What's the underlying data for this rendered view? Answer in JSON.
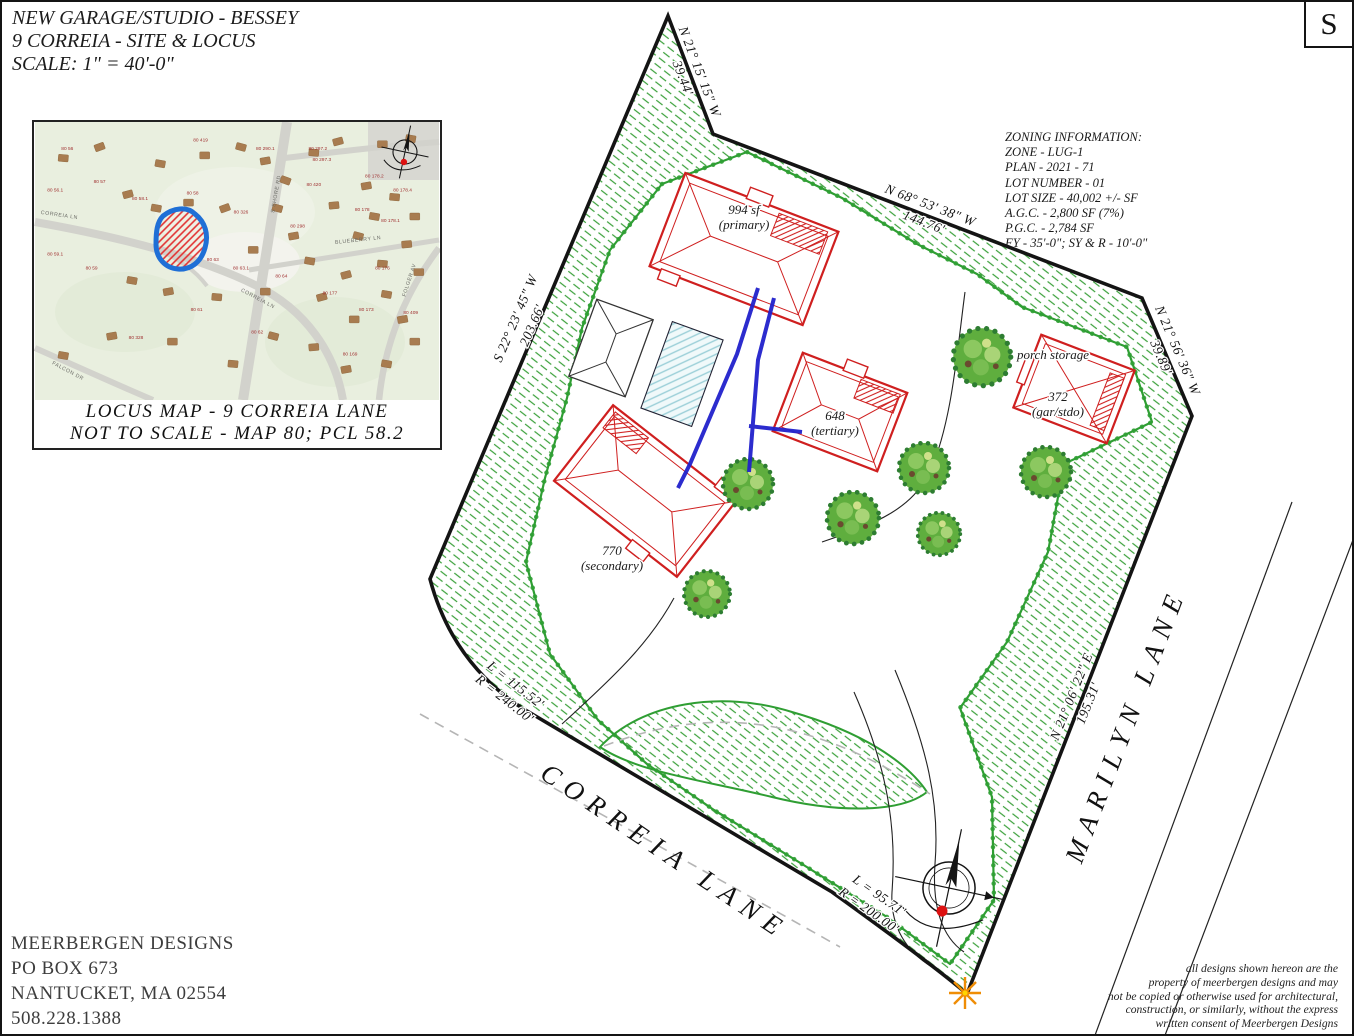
{
  "title_block": {
    "line1": "NEW GARAGE/STUDIO - BESSEY",
    "line2": "9 CORREIA - SITE & LOCUS",
    "line3": "SCALE:  1\" = 40'-0\""
  },
  "sheet_label": "S",
  "locus_map": {
    "caption_line1": "LOCUS MAP  -  9  CORREIA  LANE",
    "caption_line2": "NOT TO SCALE - MAP 80; PCL 58.2",
    "road_labels": [
      {
        "text": "CORREIA LN",
        "x": 6,
        "y": 34,
        "angle": 8
      },
      {
        "text": "CORREIA LN",
        "x": 55,
        "y": 64,
        "angle": 28
      },
      {
        "text": "S SHORE RD",
        "x": 60,
        "y": 26,
        "angle": -80
      },
      {
        "text": "BLUEBERRY LN",
        "x": 80,
        "y": 43,
        "angle": -6
      },
      {
        "text": "FALCON DR",
        "x": 8,
        "y": 90,
        "angle": 28
      },
      {
        "text": "FOLGER AV",
        "x": 93,
        "y": 57,
        "angle": -72
      }
    ],
    "parcel_labels": [
      {
        "text": "80 56",
        "x": 8,
        "y": 10
      },
      {
        "text": "80 419",
        "x": 41,
        "y": 7
      },
      {
        "text": "80 290.1",
        "x": 57,
        "y": 10
      },
      {
        "text": "80 297.2",
        "x": 70,
        "y": 10
      },
      {
        "text": "80 297.3",
        "x": 71,
        "y": 14
      },
      {
        "text": "80 57",
        "x": 16,
        "y": 22
      },
      {
        "text": "80 56.1",
        "x": 5,
        "y": 25
      },
      {
        "text": "80 58.1",
        "x": 26,
        "y": 28
      },
      {
        "text": "80 58",
        "x": 39,
        "y": 26
      },
      {
        "text": "80 420",
        "x": 69,
        "y": 23
      },
      {
        "text": "80 178.2",
        "x": 84,
        "y": 20
      },
      {
        "text": "80 178.4",
        "x": 91,
        "y": 25
      },
      {
        "text": "80 326",
        "x": 51,
        "y": 33
      },
      {
        "text": "80 178",
        "x": 81,
        "y": 32
      },
      {
        "text": "80 298",
        "x": 65,
        "y": 38
      },
      {
        "text": "80 178.1",
        "x": 88,
        "y": 36
      },
      {
        "text": "80 59.1",
        "x": 5,
        "y": 48
      },
      {
        "text": "80 59",
        "x": 14,
        "y": 53
      },
      {
        "text": "80 63",
        "x": 44,
        "y": 50
      },
      {
        "text": "80 63.1",
        "x": 51,
        "y": 53
      },
      {
        "text": "80 64",
        "x": 61,
        "y": 56
      },
      {
        "text": "80 176",
        "x": 86,
        "y": 53
      },
      {
        "text": "80 177",
        "x": 73,
        "y": 62
      },
      {
        "text": "80 61",
        "x": 40,
        "y": 68
      },
      {
        "text": "80 173",
        "x": 82,
        "y": 68
      },
      {
        "text": "80 328",
        "x": 25,
        "y": 78
      },
      {
        "text": "80 62",
        "x": 55,
        "y": 76
      },
      {
        "text": "80 169",
        "x": 78,
        "y": 84
      },
      {
        "text": "80 409",
        "x": 93,
        "y": 69
      }
    ],
    "buildings": [
      [
        16,
        9,
        -20
      ],
      [
        31,
        15,
        10
      ],
      [
        42,
        12,
        0
      ],
      [
        51,
        9,
        15
      ],
      [
        57,
        14,
        -10
      ],
      [
        69,
        11,
        5
      ],
      [
        75,
        7,
        -15
      ],
      [
        86,
        8,
        0
      ],
      [
        93,
        6,
        10
      ],
      [
        62,
        21,
        20
      ],
      [
        82,
        23,
        -10
      ],
      [
        89,
        27,
        5
      ],
      [
        23,
        26,
        -15
      ],
      [
        30,
        31,
        10
      ],
      [
        38,
        29,
        0
      ],
      [
        47,
        31,
        -20
      ],
      [
        60,
        31,
        15
      ],
      [
        74,
        30,
        -5
      ],
      [
        84,
        34,
        10
      ],
      [
        94,
        34,
        0
      ],
      [
        64,
        41,
        -10
      ],
      [
        80,
        41,
        15
      ],
      [
        92,
        44,
        -5
      ],
      [
        54,
        46,
        0
      ],
      [
        68,
        50,
        10
      ],
      [
        77,
        55,
        -15
      ],
      [
        86,
        51,
        5
      ],
      [
        95,
        54,
        0
      ],
      [
        24,
        57,
        10
      ],
      [
        33,
        61,
        -10
      ],
      [
        45,
        63,
        5
      ],
      [
        57,
        61,
        0
      ],
      [
        71,
        63,
        -15
      ],
      [
        87,
        62,
        10
      ],
      [
        79,
        71,
        0
      ],
      [
        91,
        71,
        -10
      ],
      [
        59,
        77,
        15
      ],
      [
        69,
        81,
        -5
      ],
      [
        94,
        79,
        0
      ],
      [
        87,
        87,
        10
      ],
      [
        77,
        89,
        -10
      ],
      [
        49,
        87,
        5
      ],
      [
        34,
        79,
        0
      ],
      [
        19,
        77,
        -10
      ],
      [
        7,
        84,
        10
      ],
      [
        7,
        13,
        5
      ]
    ]
  },
  "zoning": {
    "title": "ZONING INFORMATION:",
    "lines": [
      "ZONE - LUG-1",
      "PLAN - 2021 - 71",
      "LOT NUMBER - 01",
      "LOT SIZE - 40,002 +/- SF",
      "A.G.C. - 2,800 SF (7%)",
      "P.G.C. - 2,784 SF",
      "FY - 35'-0\"; SY & R - 10'-0\""
    ]
  },
  "site_plan": {
    "bearing_labels": [
      {
        "line1": "N 21° 15' 15\" W",
        "line2": "39.44'",
        "x": 689,
        "y": 73,
        "angle": 69
      },
      {
        "line1": "N 68° 53' 38\" W",
        "line2": "144.76'",
        "x": 925,
        "y": 212,
        "angle": 21
      },
      {
        "line1": "N 21° 56' 36\" W",
        "line2": "39.89'",
        "x": 1167,
        "y": 352,
        "angle": 67
      },
      {
        "line1": "N 21° 06' 22\" E",
        "line2": "195.31'",
        "x": 1078,
        "y": 698,
        "angle": -68
      },
      {
        "line1": "S 22° 23' 45\" W",
        "line2": "203.66'",
        "x": 522,
        "y": 320,
        "angle": -67
      },
      {
        "line1": "L = 115.52'",
        "line2": "R = 240.00'",
        "x": 508,
        "y": 690,
        "angle": 38
      },
      {
        "line1": "L = 95.71'",
        "line2": "R = 200.00'",
        "x": 872,
        "y": 901,
        "angle": 35
      }
    ],
    "street_labels": [
      {
        "text": "CORREIA LANE",
        "x": 658,
        "y": 857,
        "angle": 34
      },
      {
        "text": "MARILYN LANE",
        "x": 1132,
        "y": 726,
        "angle": -69
      }
    ],
    "building_labels": [
      {
        "line1": "994 sf",
        "line2": "(primary)",
        "x": 742,
        "y": 212
      },
      {
        "line1": "770",
        "line2": "(secondary)",
        "x": 610,
        "y": 553
      },
      {
        "line1": "648",
        "line2": "(tertiary)",
        "x": 833,
        "y": 418
      },
      {
        "line1": "372",
        "line2": "(gar/stdo)",
        "x": 1056,
        "y": 399
      }
    ],
    "porch_label": {
      "text": "porch storage",
      "x": 1051,
      "y": 357
    },
    "trees": [
      {
        "x": 705,
        "y": 592,
        "r": 24
      },
      {
        "x": 746,
        "y": 482,
        "r": 26
      },
      {
        "x": 851,
        "y": 516,
        "r": 27
      },
      {
        "x": 922,
        "y": 466,
        "r": 26
      },
      {
        "x": 937,
        "y": 532,
        "r": 22
      },
      {
        "x": 980,
        "y": 355,
        "r": 30
      },
      {
        "x": 1044,
        "y": 470,
        "r": 26
      }
    ]
  },
  "firm_block": {
    "lines": [
      "MEERBERGEN DESIGNS",
      "PO BOX 673",
      "NANTUCKET, MA 02554",
      "508.228.1388"
    ]
  },
  "copyright": {
    "lines": [
      "all designs shown hereon are the",
      "property of meerbergen designs and may",
      "not be copied or otherwise used for architectural,",
      "construction, or similarly, without the express",
      "written consent of Meerbergen Designs"
    ]
  },
  "colors": {
    "boundary": "#141414",
    "building_red": "#cf1f1f",
    "hedge_green": "#2f9e33",
    "pipe_blue": "#2121cc",
    "pool_cyan": "#9bcfd8",
    "subject_blue": "#1f6fd6",
    "subject_red": "#e23030",
    "marker_orange": "#ef8d05",
    "marker_yellow": "#ffd400"
  }
}
